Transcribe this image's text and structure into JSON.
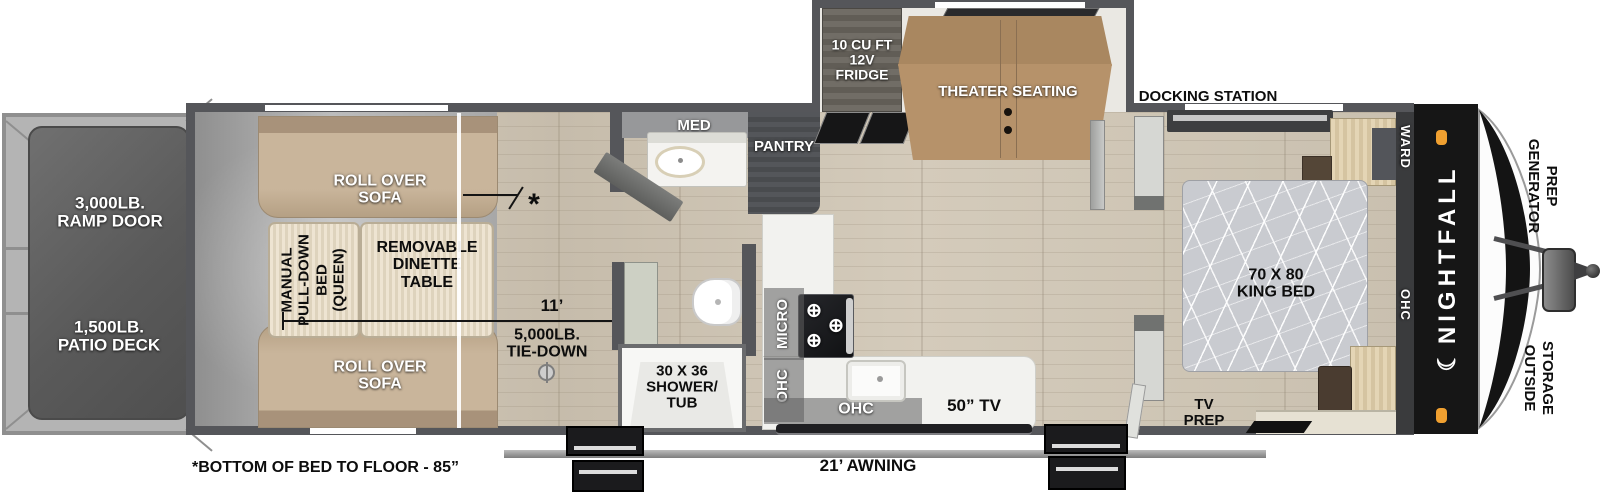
{
  "colors": {
    "wall": "#55565a",
    "clearance_light": "#f0a030",
    "sofa_tan": "#c2ad93",
    "theater_tan": "#b08d68",
    "panel_black": "#161616"
  },
  "rear": {
    "ramp_line1": "3,000LB.",
    "ramp_line2": "RAMP DOOR",
    "patio_line1": "1,500LB.",
    "patio_line2": "PATIO DECK"
  },
  "garage": {
    "sofa_line1": "ROLL OVER",
    "sofa_line2": "SOFA",
    "bed_line1": "MANUAL",
    "bed_line2": "PULL-DOWN",
    "bed_line3": "BED",
    "bed_line4": "(QUEEN)",
    "dinette_line1": "REMOVABLE",
    "dinette_line2": "DINETTE",
    "dinette_line3": "TABLE",
    "length": "11’",
    "tie_line1": "5,000LB.",
    "tie_line2": "TIE-DOWN",
    "asterisk": "*",
    "footnote": "*BOTTOM OF BED TO FLOOR - 85”"
  },
  "bath": {
    "med": "MED",
    "shower_line1": "30 X 36",
    "shower_line2": "SHOWER/",
    "shower_line3": "TUB"
  },
  "kitchen": {
    "pantry": "PANTRY",
    "micro": "MICRO",
    "ohc_vertical": "OHC",
    "ohc_horizontal": "OHC",
    "tv": "50” TV"
  },
  "slide": {
    "fridge_line1": "10 CU FT",
    "fridge_line2": "12V",
    "fridge_line3": "FRIDGE",
    "theater": "THEATER SEATING"
  },
  "exterior": {
    "awning": "21’ AWNING",
    "docking": "DOCKING STATION"
  },
  "bedroom": {
    "bed_line1": "70 X 80",
    "bed_line2": "KING BED",
    "ward": "WARD",
    "ohc": "OHC",
    "tv_prep_line1": "TV",
    "tv_prep_line2": "PREP"
  },
  "front": {
    "brand": "NIGHTFALL",
    "crescent": "☾",
    "gen_line1": "GENERATOR",
    "gen_line2": "PREP",
    "storage_line1": "OUTSIDE",
    "storage_line2": "STORAGE"
  }
}
